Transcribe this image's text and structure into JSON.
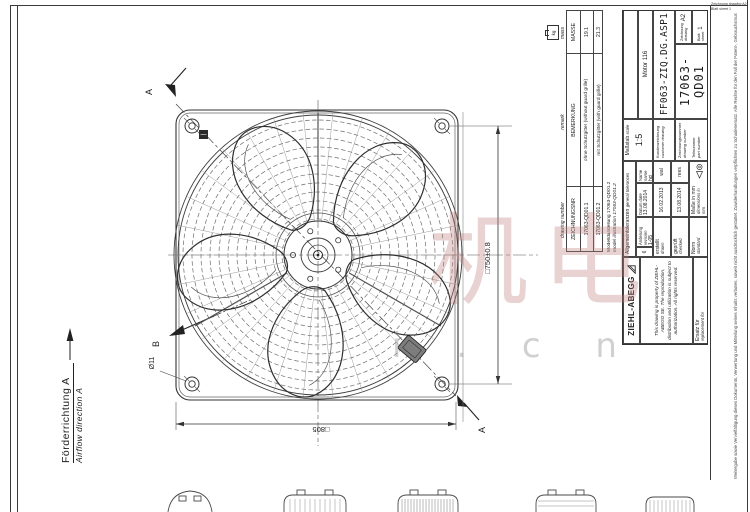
{
  "watermark": {
    "glyphs": "机电",
    "domain_text": "i . c n"
  },
  "drawing_view": {
    "airflow_de": "Förderrichtung A",
    "airflow_en": "Airflow direction A",
    "section_label": "A",
    "view_label": "B",
    "dim_hole_pitch": "□750±0.8",
    "dim_plate_size": "□805",
    "dim_hole_diameter": "Ø11"
  },
  "variant_table": {
    "en_headers": {
      "number": "drawing number",
      "remark": "remark",
      "mass": "mass"
    },
    "de_headers": {
      "number": "ZEICHNUNGSNR",
      "remark": "BEMERKUNG",
      "mass": "MASSE"
    },
    "mass_unit": "kg",
    "rows": [
      {
        "number": "17063-QD01.1",
        "remark": "ohne Schutzgitter (without guard grille)",
        "mass": "19.1"
      },
      {
        "number": "17063-QD01.2",
        "remark": "mit Schutzgitter (with guard grille)",
        "mass": "21.3"
      }
    ]
  },
  "model_note": {
    "de": "Modelldarstellung 17063-QD01.2",
    "en": "model illustration 17063-QD01.2"
  },
  "title_block": {
    "company": "ZIEHL-ABEGG",
    "property_note": "This drawing is property of ZIEHL-ABEGG SE. The reproduction, distribution and utilization is subject to authorization. All rights reserved.",
    "replacement": {
      "de": "Ersatz für",
      "en": "replacement for"
    },
    "tolerances": {
      "de": "Allgemeintoleranzen",
      "en": "general tolerances"
    },
    "revision": {
      "index": "6",
      "change_de": "Änderung",
      "change_en": "revision",
      "value": "1-05",
      "date_de": "Datum",
      "date_en": "date",
      "date": "13.08.2014",
      "name_de": "Name",
      "name_en": "name",
      "name": "hci"
    },
    "drawn": {
      "de": "erstellt",
      "en": "drawn",
      "date": "16.02.2013",
      "name": "wal"
    },
    "checked": {
      "de": "geprüft",
      "en": "checked",
      "date": "13.08.2014",
      "name": "rees"
    },
    "standard": {
      "de": "Norm",
      "en": "standard"
    },
    "units_note": {
      "de": "Maße in mm",
      "en": "dimensions in mm"
    },
    "scale": {
      "de": "Maßstab",
      "en": "scale",
      "value": "1:5"
    },
    "motor": "Motor 116",
    "customer_drawing": {
      "de": "Kundenzeichnung",
      "en": "customer drawing",
      "value": "FF063-ZIQ.DG.ASP1"
    },
    "drawing_number": {
      "de": "Zeichnungsnummer",
      "en": "drawing number",
      "value": "17063-QD01"
    },
    "part_number": {
      "de": "Teilnummer",
      "en": "part number"
    },
    "format": {
      "de": "Zeichnung",
      "en": "drawing",
      "value": "A2"
    },
    "sheet": {
      "de": "Blatt",
      "en": "sheet",
      "value": "1"
    },
    "legal_note": "Weitergabe sowie Vervielfältigung dieses Dokuments, Verwertung und Mitteilung seines Inhalts verboten, soweit nicht ausdrücklich gestattet. Zuwiderhandlungen verpflichten zu Schadenersatz. Alle Rechte für den Fall der Patent-, Gebrauchsmuster- oder Geschmacksmustereintragung vorbehalten."
  }
}
